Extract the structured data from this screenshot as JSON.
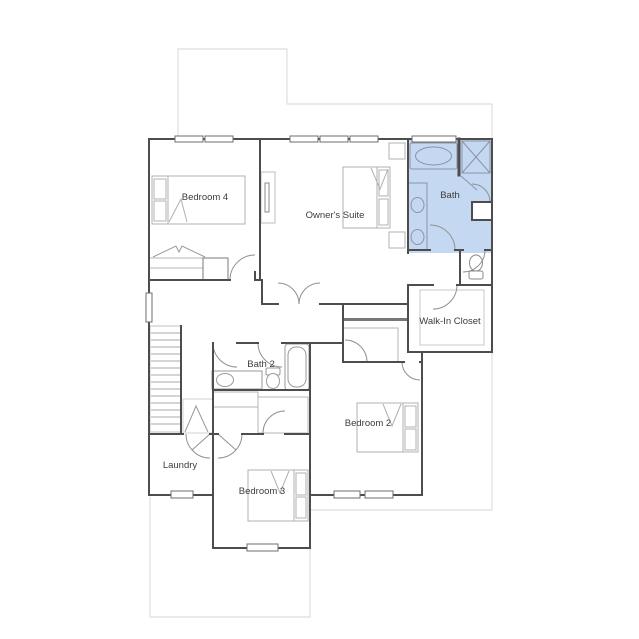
{
  "figure": {
    "type": "residential floor plan",
    "highlighted_room": "Bath"
  },
  "colors": {
    "highlight_fill": "#c5d8f2",
    "wall": "#4d4d4d",
    "fixture": "#9a9a9a",
    "footprint_outline": "#dedede",
    "label_text": "#3c3c3c",
    "background": "#ffffff"
  },
  "rooms": {
    "bedroom4": {
      "label": "Bedroom 4",
      "highlighted": false
    },
    "owners_suite": {
      "label": "Owner's Suite",
      "highlighted": false
    },
    "bath": {
      "label": "Bath",
      "highlighted": true
    },
    "walk_in_closet": {
      "label": "Walk-In Closet",
      "highlighted": false
    },
    "bath2": {
      "label": "Bath 2",
      "highlighted": false
    },
    "bedroom2": {
      "label": "Bedroom 2",
      "highlighted": false
    },
    "laundry": {
      "label": "Laundry",
      "highlighted": false
    },
    "bedroom3": {
      "label": "Bedroom 3",
      "highlighted": false
    }
  },
  "fixtures": {
    "bath": [
      "bathtub",
      "shower",
      "double-sink-vanity",
      "toilet"
    ],
    "bath2": [
      "sink-vanity",
      "toilet",
      "bathtub"
    ],
    "bedrooms": [
      "bed-bedroom4",
      "bed-owners-suite",
      "bed-bedroom2",
      "bed-bedroom3"
    ],
    "other": [
      "staircase",
      "linen-shelf",
      "closets",
      "windows",
      "doors"
    ]
  }
}
